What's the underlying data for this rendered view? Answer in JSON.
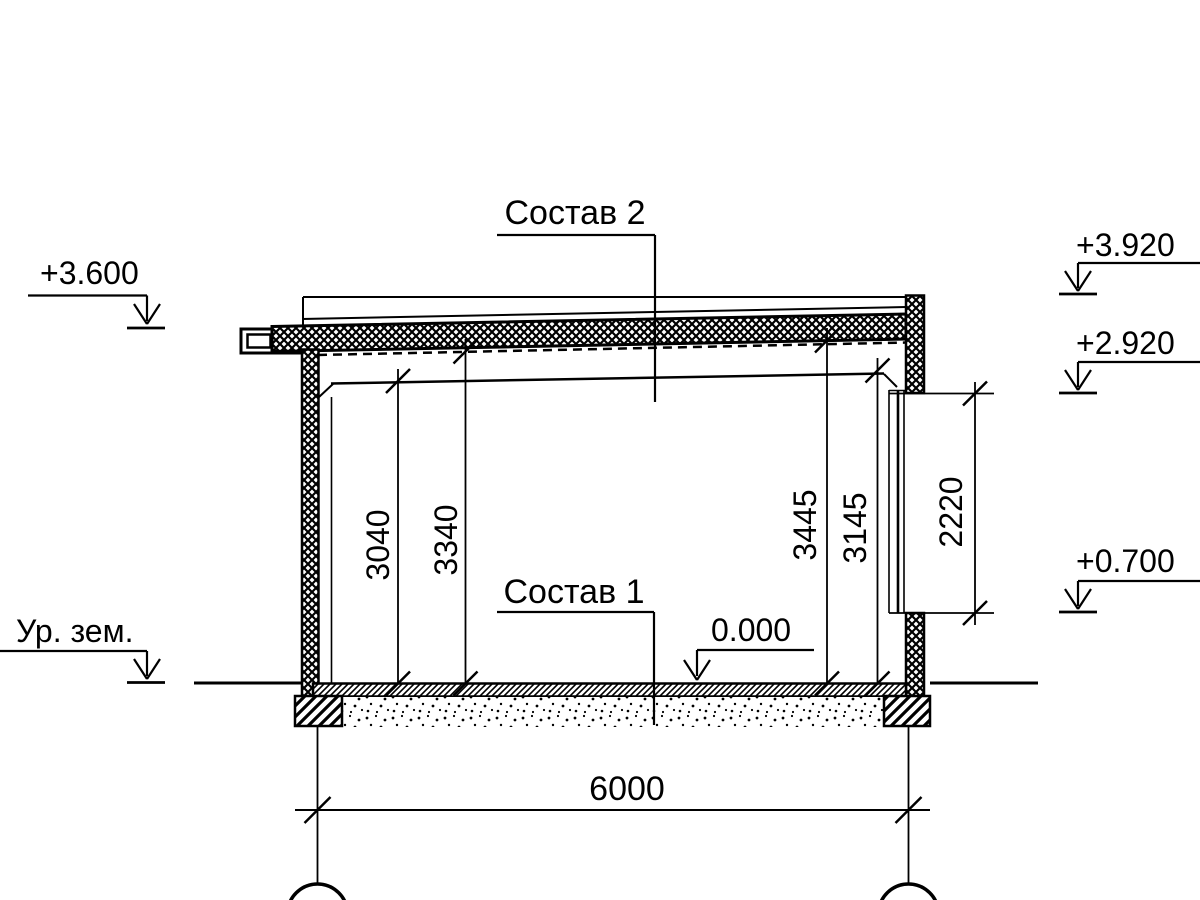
{
  "drawing": {
    "type": "architectural-section",
    "composition_labels": {
      "roof": "Состав 2",
      "floor": "Состав 1"
    },
    "elevation_marks": {
      "eave": "+3.600",
      "ground": "Ур. зем.",
      "parapet": "+3.920",
      "window_head": "+2.920",
      "window_sill": "+0.700",
      "floor_zero": "0.000"
    },
    "dimensions": {
      "clear_height_left": "3040",
      "deck_height_left": "3340",
      "deck_height_right": "3445",
      "clear_height_right": "3145",
      "window_opening": "2220",
      "span": "6000"
    },
    "colors": {
      "line": "#000000",
      "background": "#ffffff"
    }
  }
}
